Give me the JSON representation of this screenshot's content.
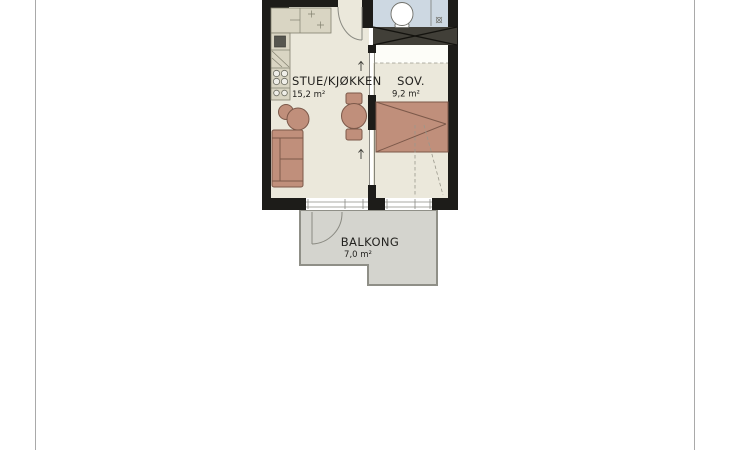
{
  "rooms": {
    "living": {
      "name": "STUE/KJØKKEN",
      "area": "15,2 m²"
    },
    "bedroom": {
      "name": "SOV.",
      "area": "9,2 m²"
    },
    "balcony": {
      "name": "BALKONG",
      "area": "7,0 m²"
    }
  },
  "colors": {
    "wall": "#1d1c19",
    "floor": "#ebe8db",
    "kitchen_counter": "#d9d5c3",
    "bathroom_floor": "#cdd8e2",
    "balcony_floor": "#d4d4ce",
    "furniture": "#c08f7b",
    "furniture_outline": "#7c594a",
    "wardrobe": "#413f38",
    "label_text": "#23221f"
  }
}
